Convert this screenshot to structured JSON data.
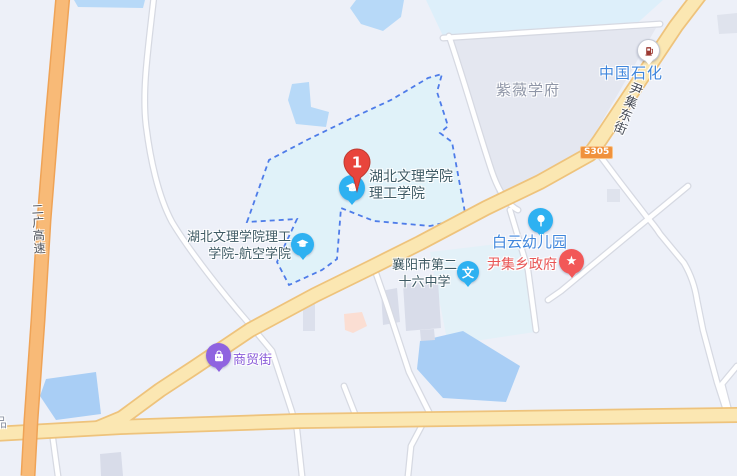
{
  "map": {
    "marker": {
      "number": "1"
    },
    "pois": {
      "ligong": {
        "line1": "湖北文理学院",
        "line2": "理工学院",
        "color": "#3E5A64",
        "icon": "graduation-cap"
      },
      "hangkong": {
        "line1": "湖北文理学院理工",
        "line2": "学院-航空学院",
        "color": "#3E5A64",
        "icon": "graduation-cap"
      },
      "school26": {
        "line1": "襄阳市第二",
        "line2": "十六中学",
        "color": "#3E5A64",
        "icon": "wen-school",
        "glyph": "文"
      },
      "baiyun": {
        "label": "白云幼儿园",
        "color": "#3F86DC",
        "icon": "pinwheel"
      },
      "yinji_gov": {
        "label": "尹集乡政府",
        "color": "#E85555",
        "icon": "star",
        "glyph": "★"
      },
      "shangmao": {
        "label": "商贸街",
        "color": "#8A5CD9",
        "icon": "shopping-bag"
      },
      "sinopec": {
        "label": "中国石化",
        "color": "#3F86DC",
        "icon": "gas-pump"
      }
    },
    "areas": {
      "ziwei": "紫薇学府"
    },
    "streets": {
      "yinji_east": "尹集东街",
      "erguang_expressway": "二广高速",
      "s305": "S305"
    },
    "edge_label_fragment": "品",
    "colors": {
      "background": "#EDF0F8",
      "highway_orange": "#F8BA77",
      "road_yellow": "#FBE7B2",
      "road_yellow_casing": "#EEC37C",
      "road_white": "#FFFFFF",
      "water_light": "#B7D9F8",
      "water_deep": "#A9CEF5",
      "campus_fill": "#E0F2F9",
      "campus_border": "#4E7CE9",
      "district_fill": "#E4E7F0",
      "building_gray": "#D8DCE9",
      "building_pink": "#FBDED3",
      "marker_red": "#E8453C",
      "poi_blue": "#2EB1F1",
      "poi_red": "#F25858",
      "poi_purple": "#8F63E0"
    }
  }
}
